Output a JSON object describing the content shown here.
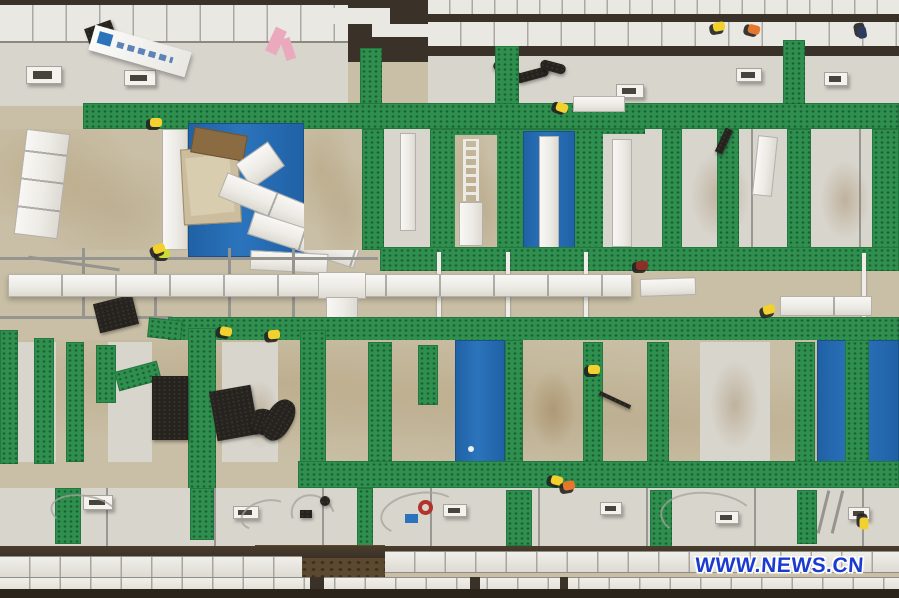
{
  "meta": {
    "description": "Aerial top-down photo of a modular construction site: rows of white and beige prefab roof panels crossed by green protective walkway strips, blue tarp-covered sections, long white duct beams forming a T, scattered black mats, cables and workers in yellow and orange safety vests; dark earth strips at top and bottom edges."
  },
  "watermark": {
    "text": "WWW.NEWS.CN"
  },
  "palette": {
    "green": "#2f8f4f",
    "green_dark": "#1f6e39",
    "blue": "#2b74bc",
    "blue_deep": "#2061a6",
    "beige": "#c9bfa6",
    "panel_light": "#d8d5cd",
    "panel_white": "#eae8e2",
    "dirt_dark": "#3a3229",
    "dirt_brown": "#5c4930",
    "watermark_blue": "#1b3bd0",
    "worker_yellow": "#f2d12e",
    "worker_orange": "#e4772b",
    "worker_navy": "#2e3b5e",
    "worker_lime": "#cddc39",
    "worker_red": "#8d2f26",
    "pink": "#eaa9bc"
  }
}
